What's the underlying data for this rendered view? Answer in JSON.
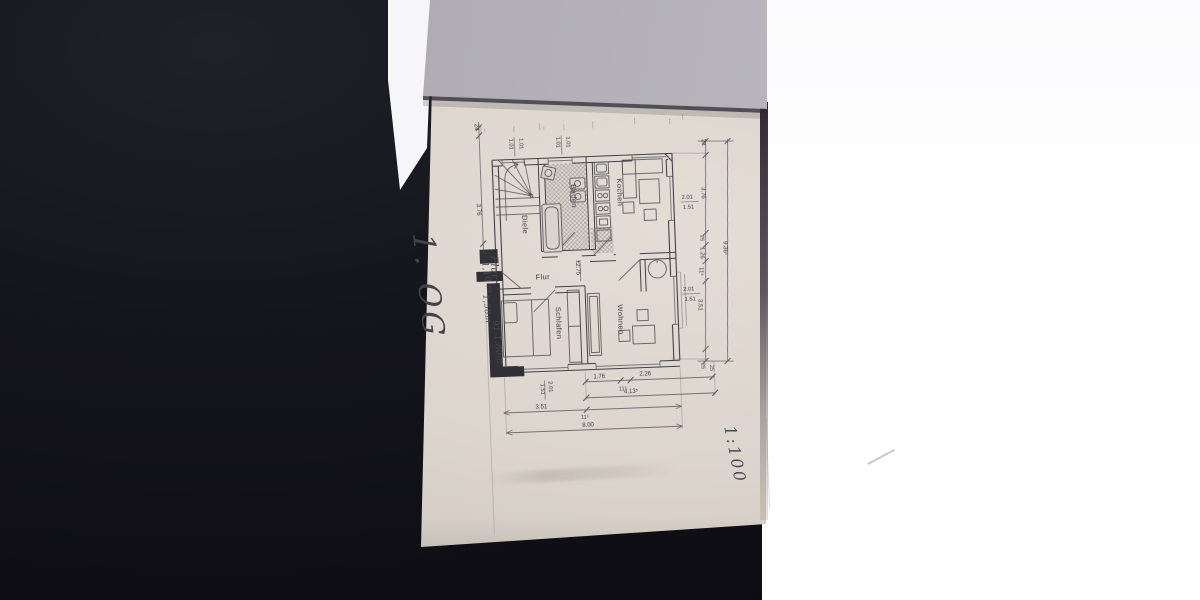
{
  "photo": {
    "colors": {
      "background_dark": "#101016",
      "plan_paper": "#d8d1c9",
      "overlay_sheet": "#b3b0b8",
      "white_sheet": "#ffffff",
      "print_ink": "#3e3d45",
      "pencil": "#4a4a55"
    }
  },
  "floor_plan": {
    "room_labels": {
      "kitchen": "Kochen",
      "bath": "Baden",
      "entry_hall": "Diele",
      "corridor": "Flur",
      "bedroom": "Schlafen",
      "living": "Wohnen"
    },
    "level_mark": "±2.75",
    "window_dims": {
      "stair_window": [
        "1.01",
        "1.01"
      ],
      "bath_window": [
        "1.01",
        "1.01"
      ],
      "kitchen_window": [
        "2.01",
        "1.51"
      ],
      "living_window": [
        "2.01",
        "1.51"
      ],
      "bedroom_window": [
        "2.01",
        "1.51"
      ]
    },
    "dim_chains": {
      "left": [
        "24",
        "3.76"
      ],
      "right": [
        "24",
        "3.76",
        "25",
        "1.26",
        "11⁵",
        "3.51",
        "25"
      ],
      "right_total": "9.36⁵",
      "bottom_row1": [
        "1.76",
        "11⁵",
        "2.26",
        "25"
      ],
      "bottom_row2": "4.13⁵",
      "bottom_row3": [
        "3.51",
        "11⁵"
      ],
      "bottom_total": "8.00"
    }
  },
  "handwriting": {
    "floor_label": "1. OG",
    "scale_label": "1:100",
    "notes": [
      "Flur",
      "1,10 m",
      "1,58m",
      "91 1,80m"
    ]
  }
}
